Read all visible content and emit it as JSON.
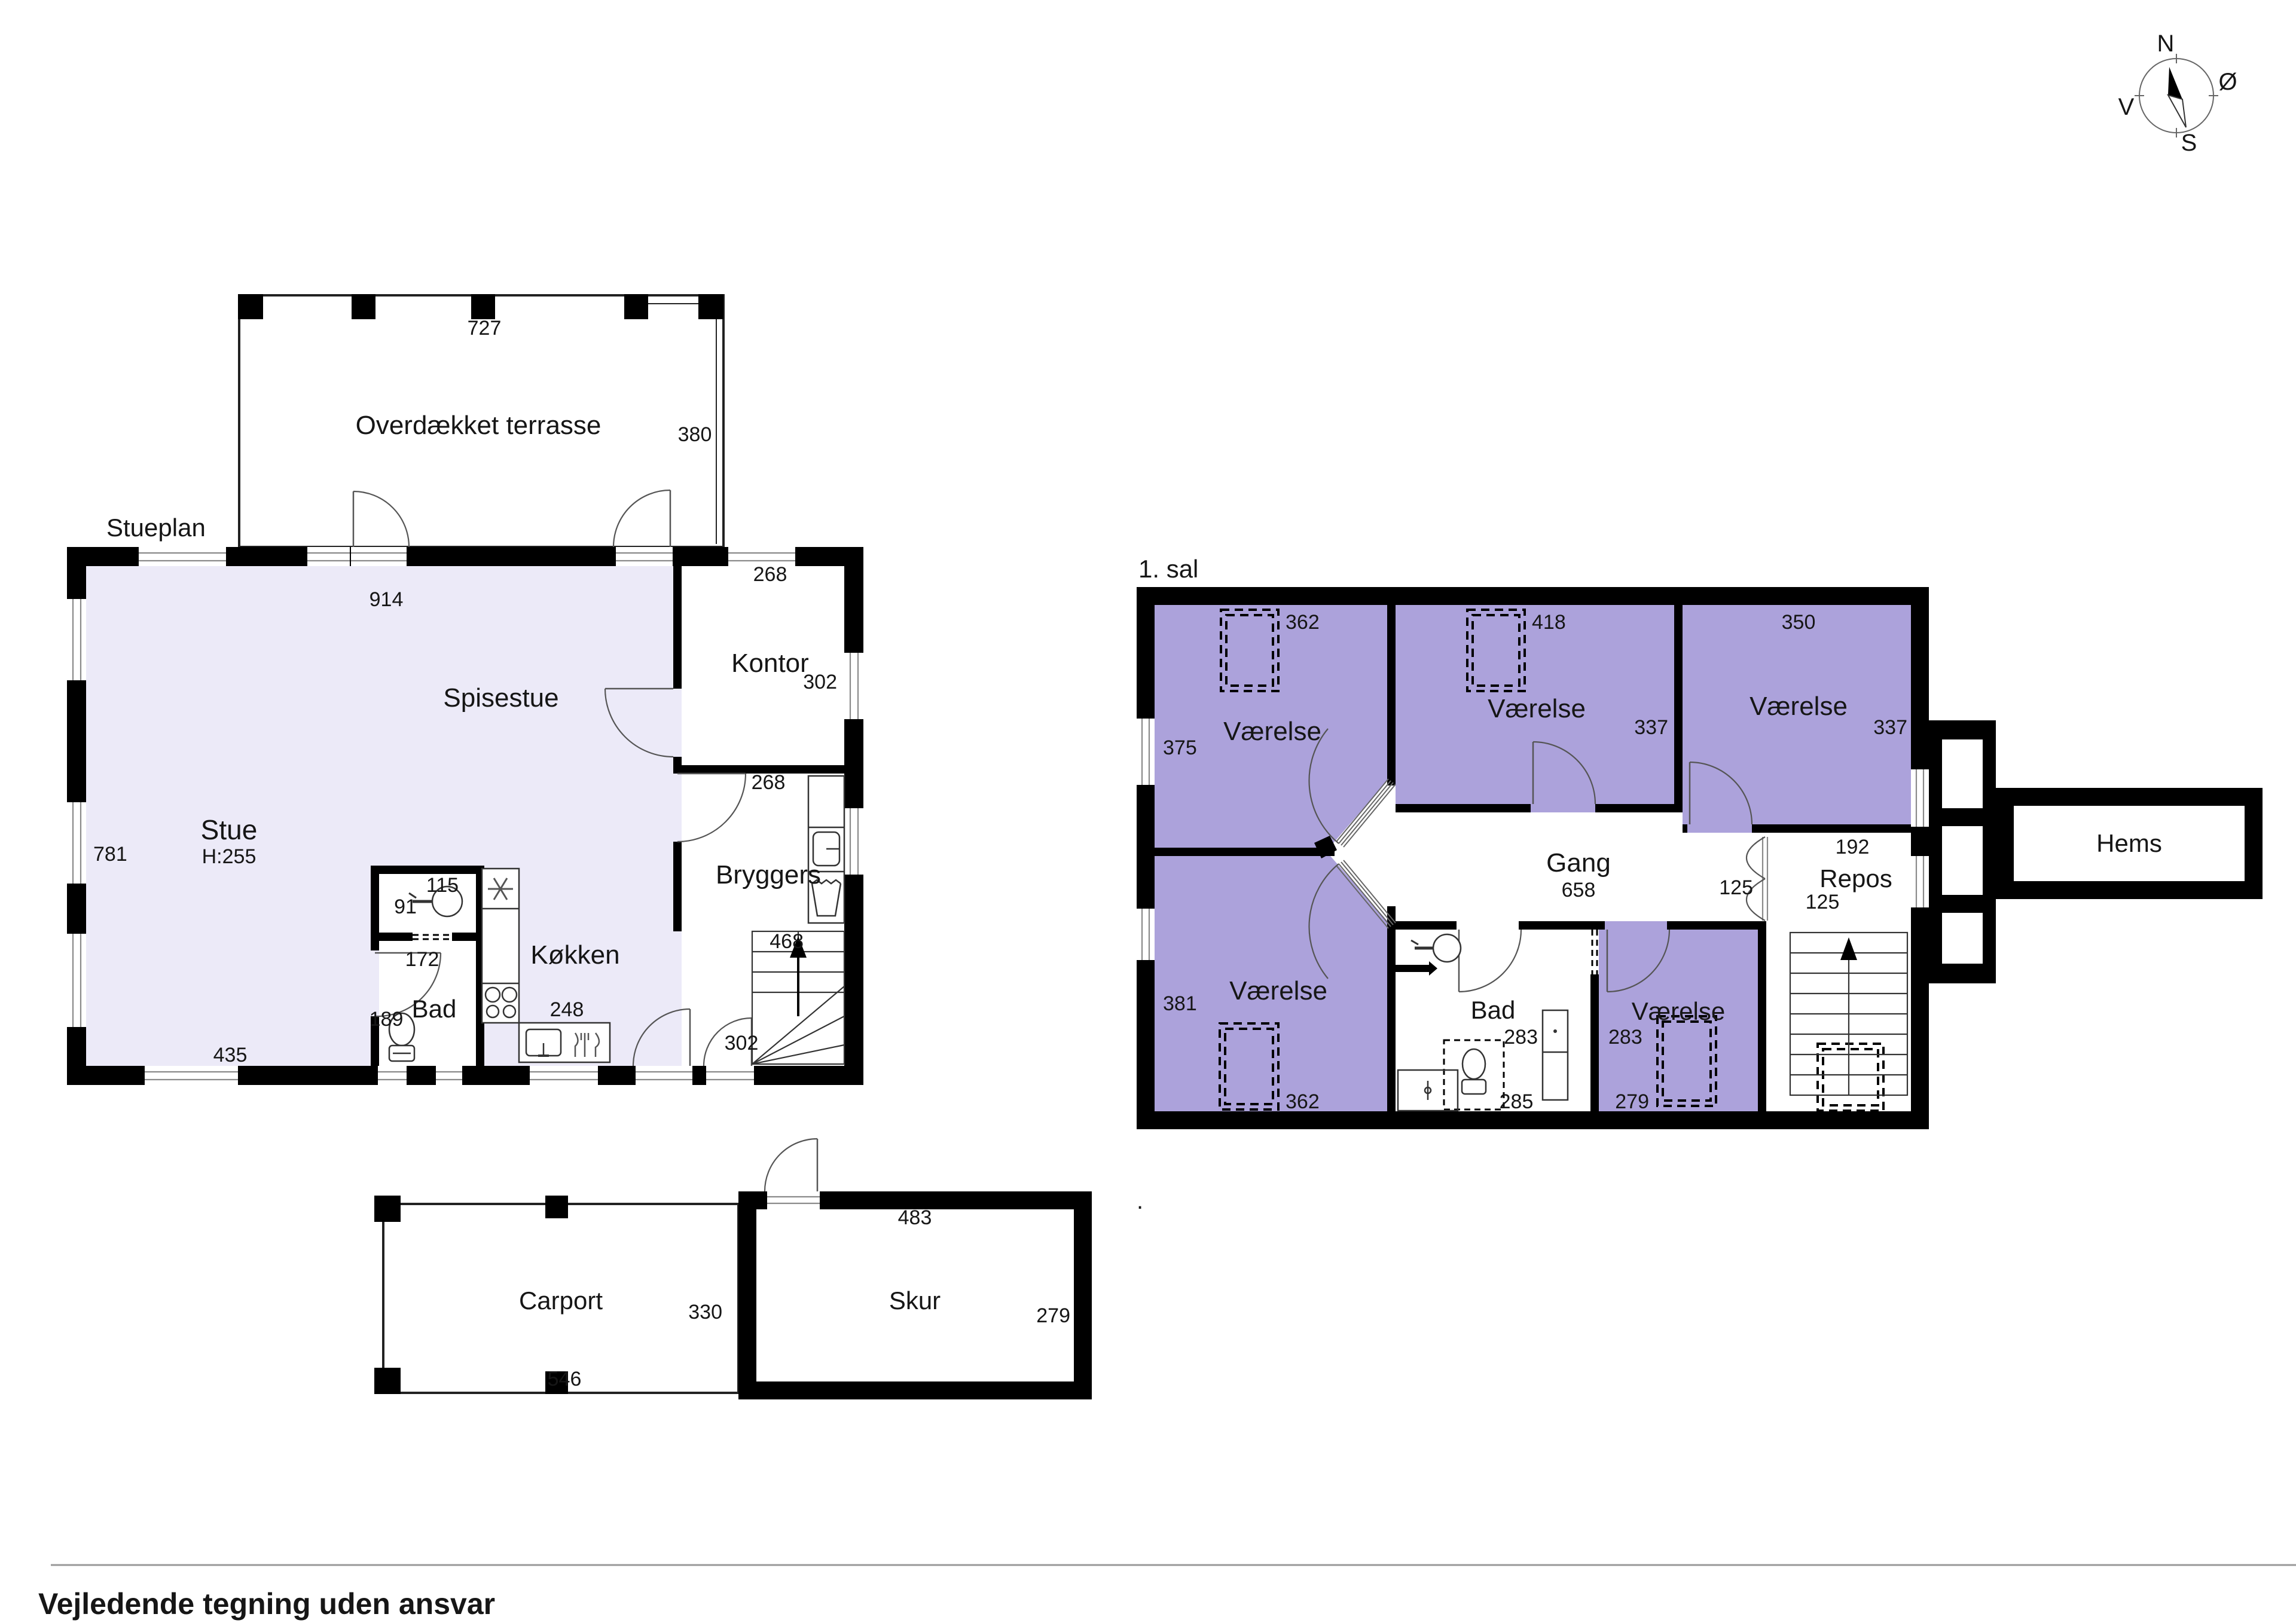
{
  "page": {
    "footer": "Vejledende tegning uden ansvar",
    "stray_dot": "."
  },
  "compass": {
    "north": "N",
    "east": "Ø",
    "south": "S",
    "west": "V"
  },
  "ground_floor": {
    "title": "Stueplan",
    "terrace": {
      "label": "Overdækket terrasse",
      "width": "727",
      "depth": "380"
    },
    "spisestue": {
      "label": "Spisestue",
      "top_width": "914"
    },
    "stue": {
      "label": "Stue",
      "ceiling_height": "H:255",
      "left_height": "781",
      "bottom_width": "435"
    },
    "kontor": {
      "label": "Kontor",
      "top_width": "268",
      "right_height": "302"
    },
    "bryggers": {
      "label": "Bryggers",
      "top_width": "268",
      "cabinet_depth": "468",
      "bottom_width": "302"
    },
    "bad": {
      "label": "Bad",
      "height": "189",
      "wc_width": "115",
      "wc_height": "91",
      "door_width": "172"
    },
    "kokken": {
      "label": "Køkken",
      "counter_width": "248"
    }
  },
  "first_floor": {
    "title": "1. sal",
    "room_top_left": {
      "label": "Værelse",
      "wardrobe_width": "362",
      "left_height": "375"
    },
    "room_top_mid": {
      "label": "Værelse",
      "wardrobe_width": "418",
      "right_height": "337"
    },
    "room_top_right": {
      "label": "Værelse",
      "top_width": "350",
      "right_height": "337"
    },
    "gang": {
      "label": "Gang",
      "length": "658",
      "width": "125"
    },
    "repos": {
      "label": "Repos",
      "top_width": "192",
      "width": "125"
    },
    "hems": {
      "label": "Hems"
    },
    "room_bottom_left": {
      "label": "Værelse",
      "left_height": "381",
      "bottom_width": "362"
    },
    "bad": {
      "label": "Bad",
      "right_height": "283",
      "bottom_width": "285"
    },
    "room_bottom_mid": {
      "label": "Værelse",
      "left_height": "283",
      "bottom_width": "279"
    }
  },
  "outbuildings": {
    "carport": {
      "label": "Carport",
      "right_height": "330",
      "bottom_width": "546"
    },
    "skur": {
      "label": "Skur",
      "top_width": "483",
      "right_height": "279"
    }
  }
}
